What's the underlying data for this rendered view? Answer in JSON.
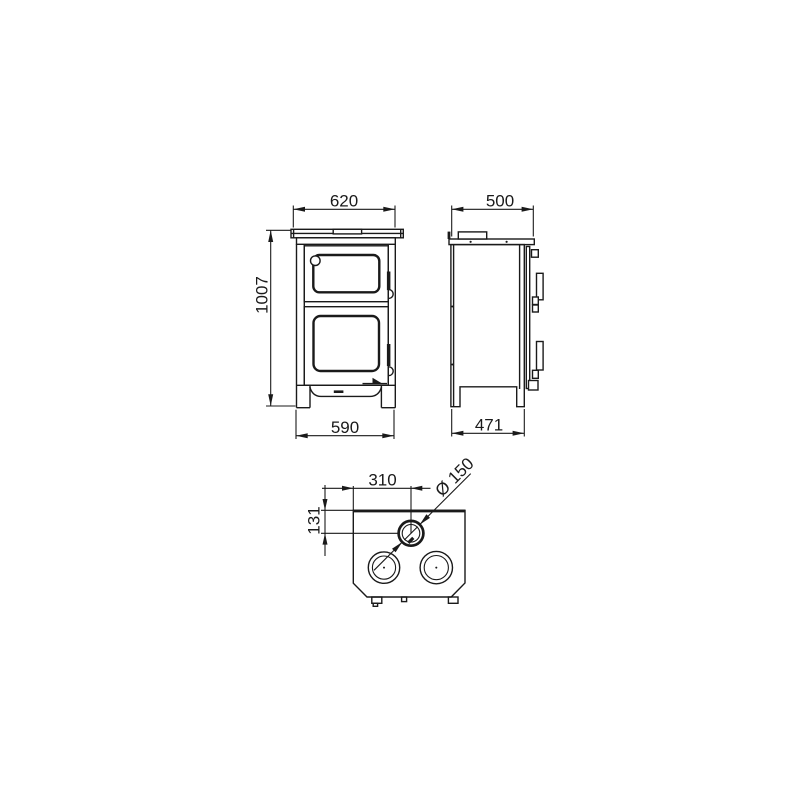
{
  "page": {
    "background_color": "#ffffff",
    "line_color": "#1a1a1a"
  },
  "drawing": {
    "front_view": {
      "top_plate_width": "620",
      "overall_height": "1007",
      "base_width": "590"
    },
    "side_view": {
      "top_plate_depth": "500",
      "base_depth": "471"
    },
    "top_view": {
      "flue_offset_from_left": "310",
      "flue_offset_from_back": "131",
      "flue_diameter_label": "Ø 150"
    }
  }
}
